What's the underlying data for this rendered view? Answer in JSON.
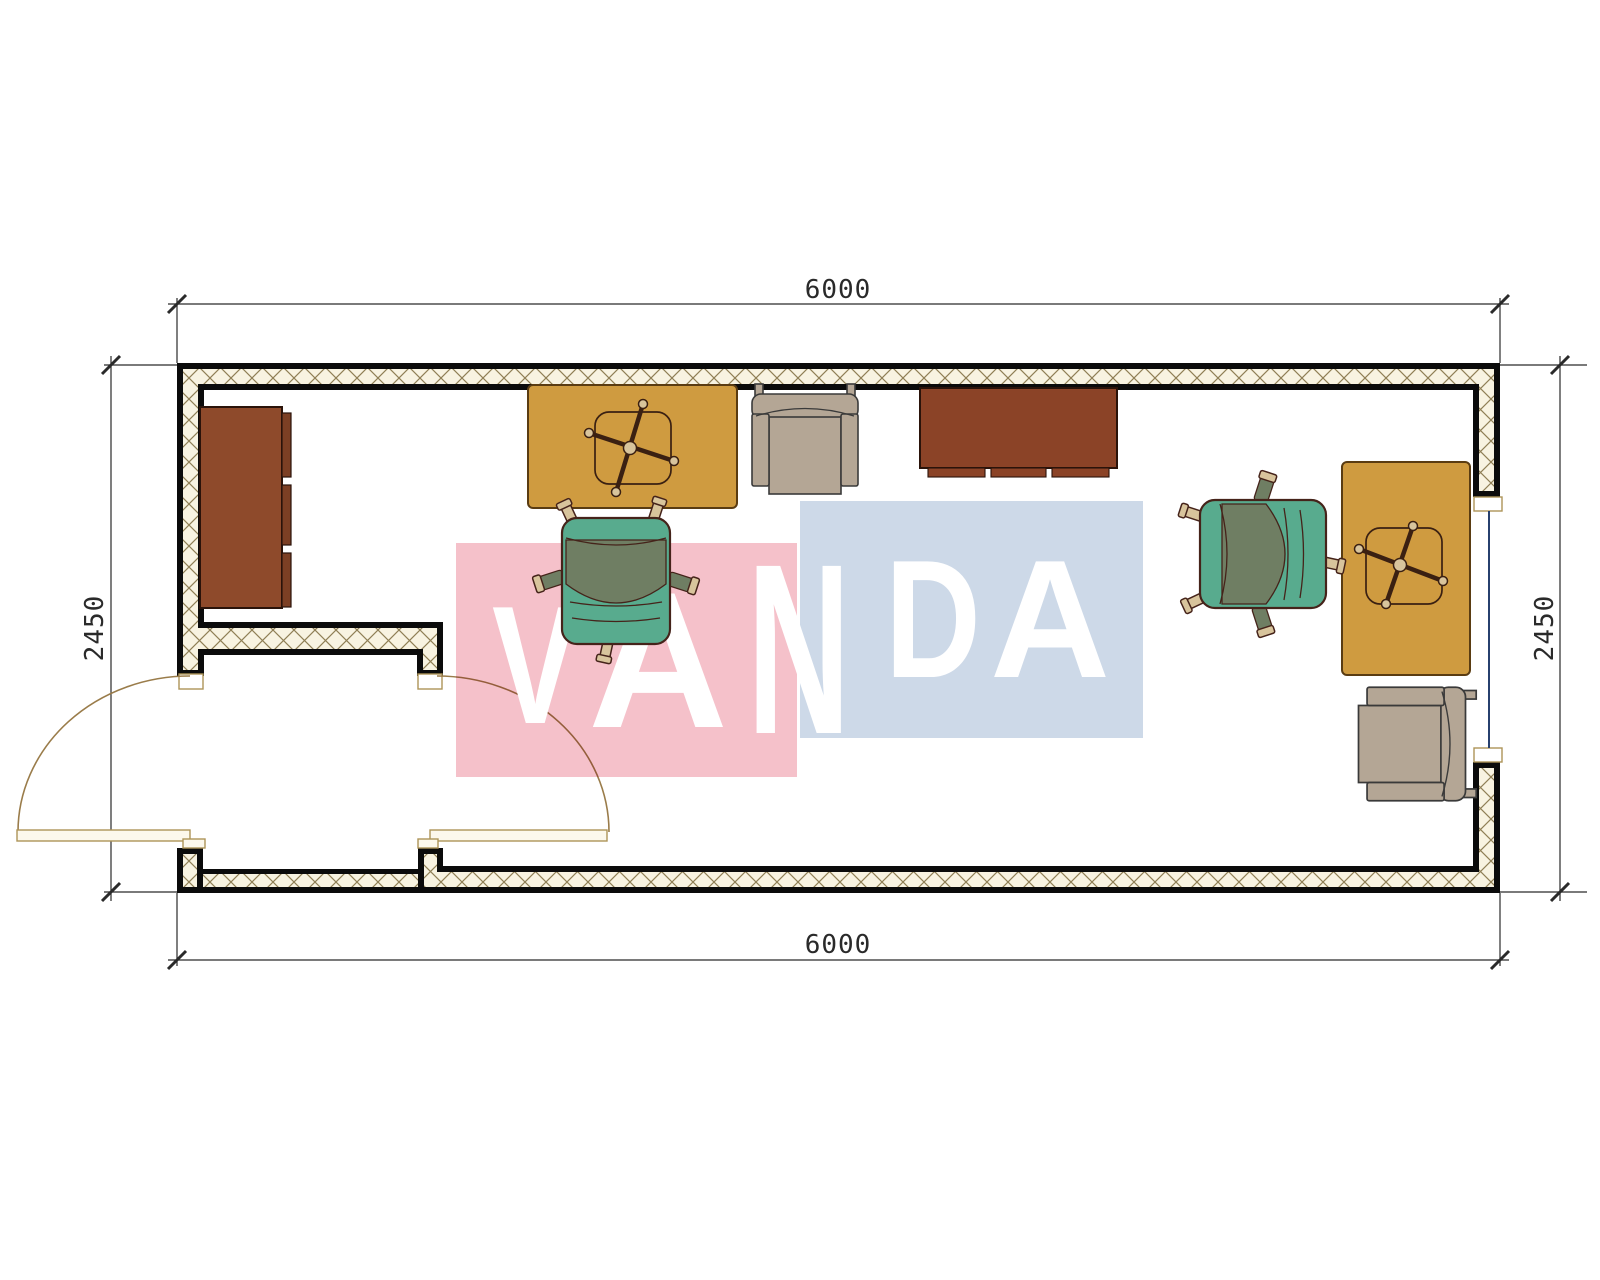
{
  "drawing": {
    "dims": {
      "top": "6000",
      "bottom": "6000",
      "left": "2450",
      "right": "2450"
    },
    "watermark": {
      "text": "VANDA",
      "pink": "#f5c1ca",
      "blue": "#cdd9e8",
      "letters": [
        {
          "ch": "V",
          "x": 492,
          "baseline": 723,
          "size": 168,
          "sx": 0.77
        },
        {
          "ch": "A",
          "x": 588,
          "baseline": 727,
          "size": 194,
          "sx": 1.0
        },
        {
          "ch": "N",
          "x": 747,
          "baseline": 733,
          "size": 243,
          "sx": 0.59
        },
        {
          "ch": "D",
          "x": 885,
          "baseline": 677,
          "size": 168,
          "sx": 0.79
        },
        {
          "ch": "A",
          "x": 990,
          "baseline": 677,
          "size": 168,
          "sx": 0.99
        }
      ]
    },
    "colors": {
      "wallInk": "#0b0b0b",
      "hatchLine": "#8f7f55",
      "hatchBg": "#f8f3e1",
      "dimInk": "#2a2a2a",
      "arcTan": "#9a7c4a",
      "frameTan": "#ad9458",
      "glazing": "#27406e",
      "deskYellow": "#cf9b40",
      "deskBorder": "#5a3c12",
      "baseInk": "#3a2012",
      "casterFill": "#d8c49c",
      "cabinetBrown": "#8e4a2b",
      "cabinetDark": "#7c3f24",
      "cabinetBorder": "#2a130a",
      "sideboardBrown": "#8b4327",
      "beige": "#b4a695",
      "beigeInk": "#3a3a3a",
      "teal": "#58ab8e",
      "olive": "#6f7e63",
      "chairInk": "#45231a",
      "leafFill": "#fcf8ec",
      "wmPink": "#f5c1ca",
      "wmBlue": "#cdd9e8"
    }
  }
}
